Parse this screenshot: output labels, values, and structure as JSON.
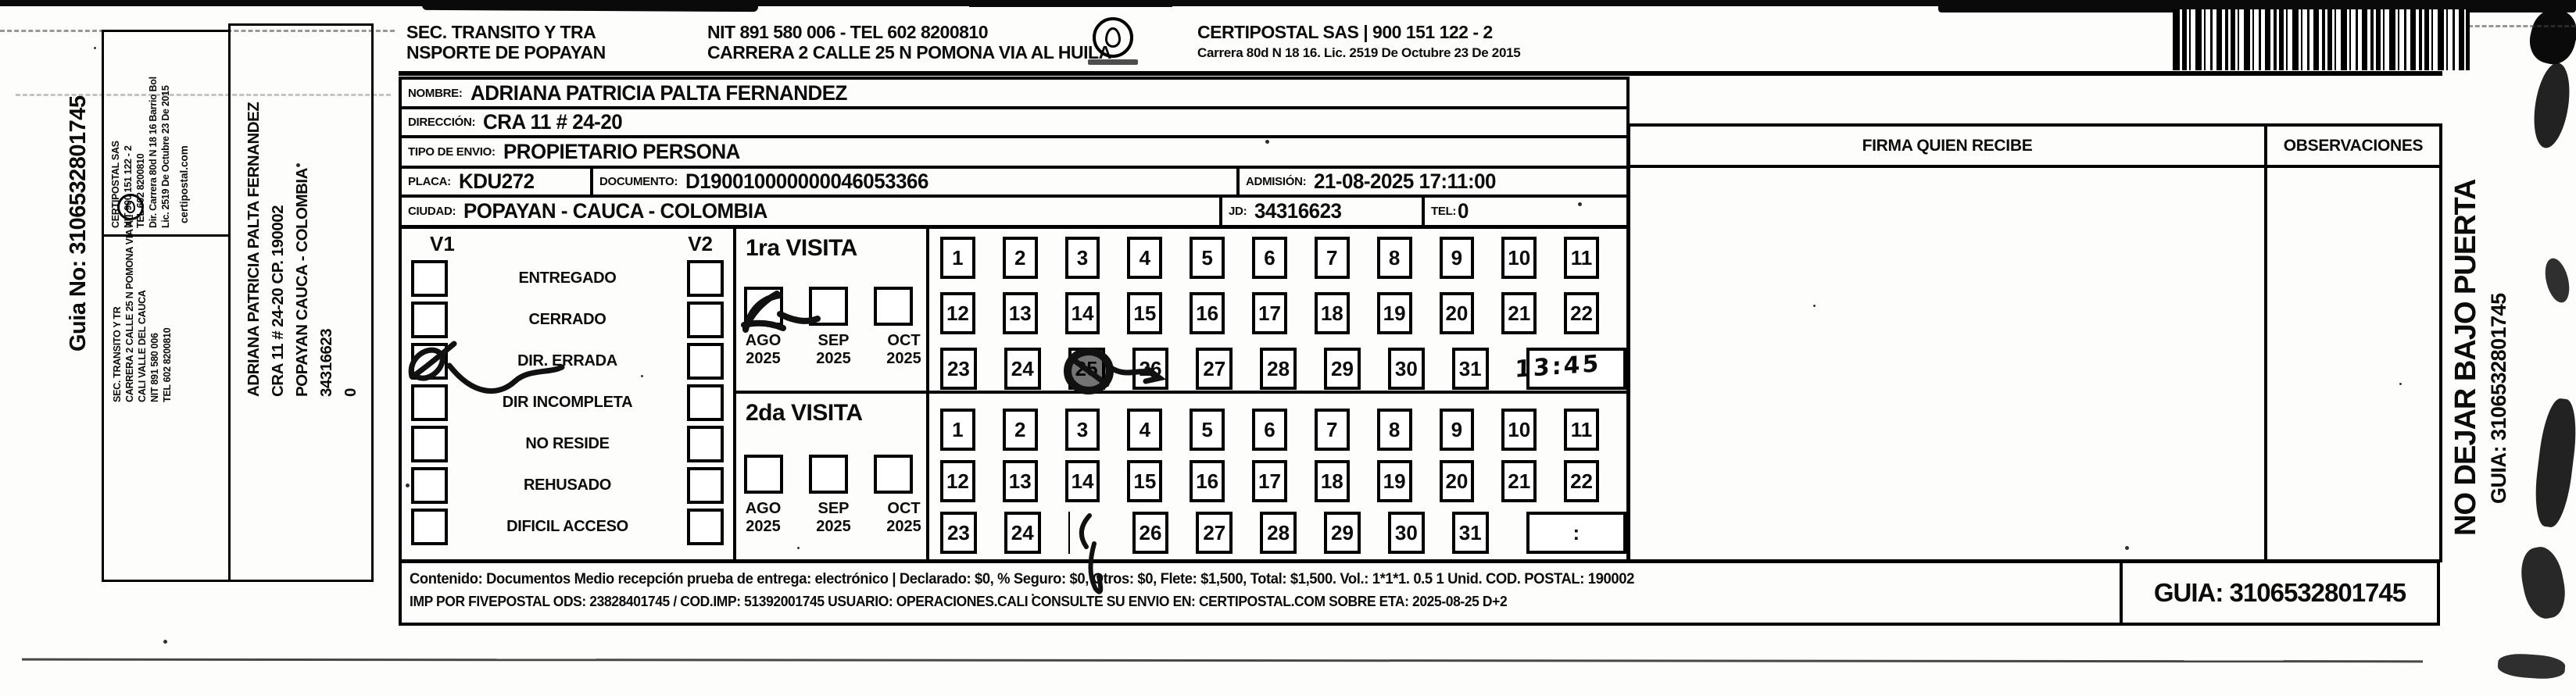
{
  "left_panel": {
    "guia_no": "Guia No: 3106532801745",
    "carrier_info": [
      "CERTIPOSTAL SAS",
      "NIT 900 151 122 - 2",
      "TEL 602 8200810",
      "Dir. Carrera 80d N 18 16 Barrio Bol",
      "Lic. 2519 De Octubre 23 De 2015"
    ],
    "carrier_web": "certipostal.com",
    "sender_info": [
      "SEC. TRANSITO Y TR",
      "CARRERA 2 CALLE 25 N POMONA VIA AL",
      "CALI VALLE DEL CAUCA",
      "NIT 891 580 006",
      "TEL 602 8200810"
    ],
    "destination_info": [
      "ADRIANA PATRICIA PALTA FERNANDEZ",
      "CRA 11 # 24-20 CP. 190002",
      "POPAYAN CAUCA - COLOMBIA",
      "34316623",
      "0"
    ]
  },
  "header": {
    "sender_line1": "SEC. TRANSITO Y TRA",
    "sender_line2": "NSPORTE DE POPAYAN",
    "sender_nit": "NIT 891 580 006 - TEL 602 8200810",
    "sender_address": "CARRERA 2 CALLE 25 N POMONA VIA AL HUILA",
    "carrier_name": "CERTIPOSTAL SAS | 900 151 122 - 2",
    "carrier_lic": "Carrera 80d N 18 16. Lic. 2519 De Octubre 23 De 2015"
  },
  "form": {
    "nombre_label": "NOMBRE:",
    "nombre": "ADRIANA PATRICIA PALTA FERNANDEZ",
    "direccion_label": "DIRECCIÓN:",
    "direccion": "CRA 11 # 24-20",
    "tipo_label": "TIPO DE ENVIO:",
    "tipo": "PROPIETARIO PERSONA",
    "placa_label": "PLACA:",
    "placa": "KDU272",
    "documento_label": "DOCUMENTO:",
    "documento": "D190010000000046053366",
    "admision_label": "ADMISIÓN:",
    "admision": "21-08-2025 17:11:00",
    "ciudad_label": "CIUDAD:",
    "ciudad": "POPAYAN - CAUCA - COLOMBIA",
    "jd_label": "JD:",
    "jd": "34316623",
    "tel_label": "TEL:",
    "tel": "0"
  },
  "visits": {
    "v1_label": "V1",
    "v2_label": "V2",
    "statuses": [
      "ENTREGADO",
      "CERRADO",
      "DIR. ERRADA",
      "DIR INCOMPLETA",
      "NO RESIDE",
      "REHUSADO",
      "DIFICIL ACCESO"
    ],
    "v1_checked_status": "DIR. ERRADA",
    "months": [
      "AGO",
      "SEP",
      "OCT"
    ],
    "month_year": "2025",
    "days": [
      1,
      2,
      3,
      4,
      5,
      6,
      7,
      8,
      9,
      10,
      11,
      12,
      13,
      14,
      15,
      16,
      17,
      18,
      19,
      20,
      21,
      22,
      23,
      24,
      25,
      26,
      27,
      28,
      29,
      30,
      31
    ],
    "visit1": {
      "title": "1ra VISITA",
      "checked_month": "AGO",
      "marked_day": 25,
      "time": "13:45"
    },
    "visit2": {
      "title": "2da VISITA",
      "marked_day": 25,
      "time_placeholder": ":"
    }
  },
  "signature": {
    "firma_label": "FIRMA QUIEN RECIBE",
    "observaciones_label": "OBSERVACIONES"
  },
  "footer": {
    "line1": "Contenido: Documentos Medio recepción prueba de entrega: electrónico | Declarado: $0, % Seguro: $0, Otros: $0, Flete: $1,500, Total: $1,500. Vol.: 1*1*1. 0.5 1 Unid. COD. POSTAL: 190002",
    "line2": "IMP POR FIVEPOSTAL ODS: 23828401745 / COD.IMP: 51392001745 USUARIO: OPERACIONES.CALI CONSULTE SU ENVIO EN: CERTIPOSTAL.COM SOBRE ETA: 2025-08-25 D+2",
    "guia": "GUIA: 3106532801745"
  },
  "right_panel": {
    "warning": "NO DEJAR BAJO PUERTA",
    "guia": "GUIA: 3106532801745"
  }
}
